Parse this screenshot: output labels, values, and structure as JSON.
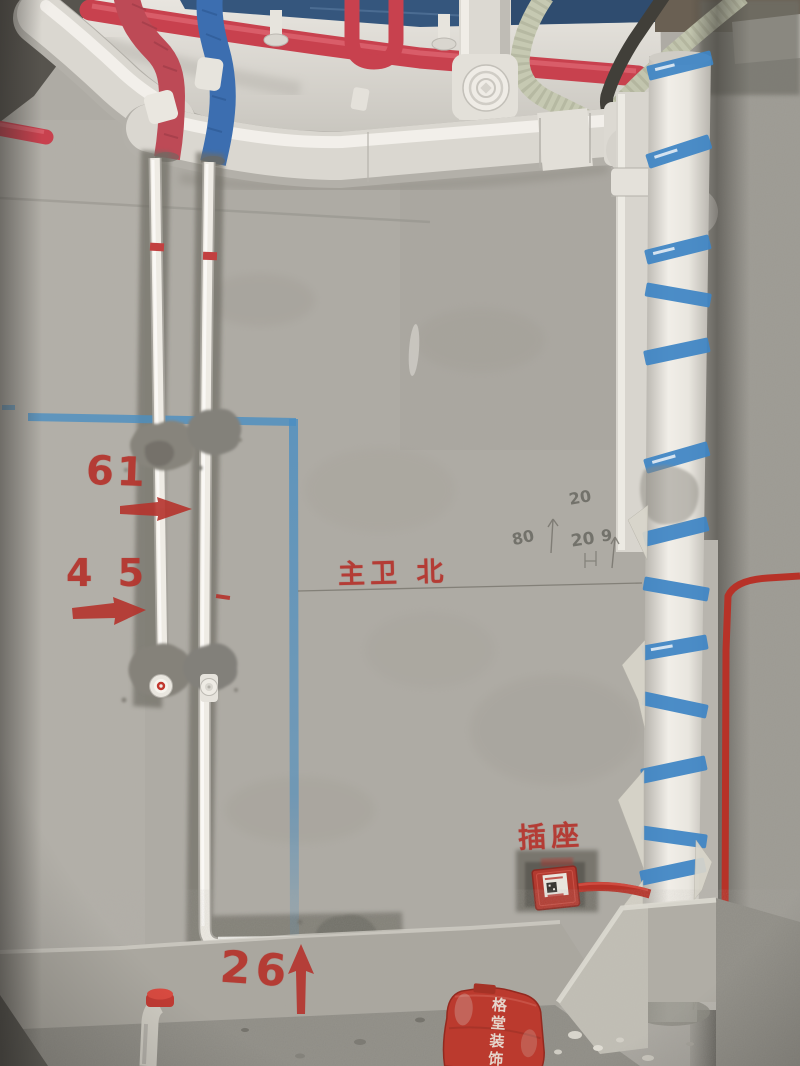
{
  "scene": {
    "type": "construction-site photo: bathroom wall plumbing rough-in"
  },
  "markings": {
    "measurement_61": "61",
    "measurement_45": "4 5",
    "measurement_26": "26",
    "room_label": "主卫 北",
    "socket_label": "插座",
    "dustpan_brand": "格堂装饰",
    "pencil_marks": [
      "20",
      "80",
      "20",
      "9"
    ]
  },
  "colors": {
    "red_marking": "#b5332c",
    "blue_tape": "#4a8ec2",
    "blue_label_band": "#3e85c5",
    "red_pipe": "#c8414e",
    "red_insulation": "#bd4a56",
    "blue_insulation": "#3c6eb0",
    "red_conduit": "#b73228",
    "wall_gray": "#aeaba4"
  }
}
